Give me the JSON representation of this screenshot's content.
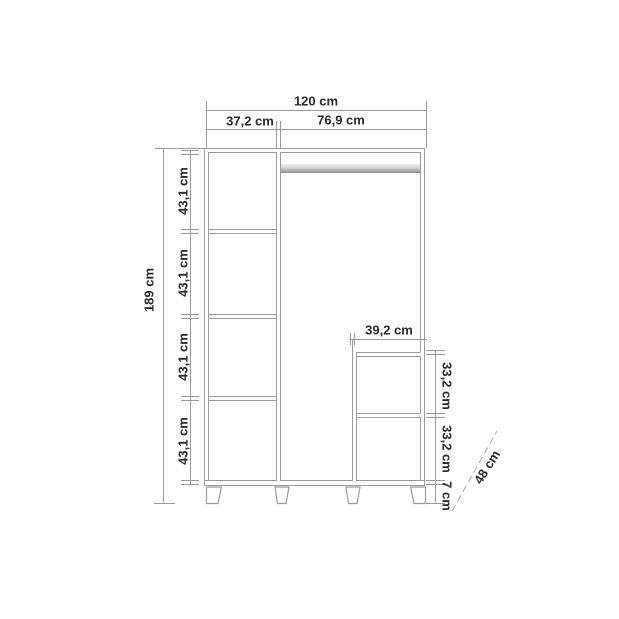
{
  "diagram": {
    "type": "furniture-dimension-drawing",
    "subject": "wardrobe front elevation with dimension callouts",
    "unit": "cm",
    "labels": {
      "total_width": "120 cm",
      "left_section_width": "37,2 cm",
      "right_section_width": "76,9 cm",
      "total_height": "189 cm",
      "left_cells": [
        "43,1 cm",
        "43,1 cm",
        "43,1 cm",
        "43,1 cm"
      ],
      "inner_unit_width": "39,2 cm",
      "inner_cells": [
        "33,2 cm",
        "33,2 cm"
      ],
      "feet_height": "7 cm",
      "depth": "48 cm"
    },
    "colors": {
      "background": "#ffffff",
      "drawing_line": "#9a9a9a",
      "dimension_line": "#9a9a9a",
      "label_text": "#2b2b2b",
      "rail_gradient_top": "#efefef",
      "rail_gradient_bottom": "#8e8e8e"
    }
  }
}
